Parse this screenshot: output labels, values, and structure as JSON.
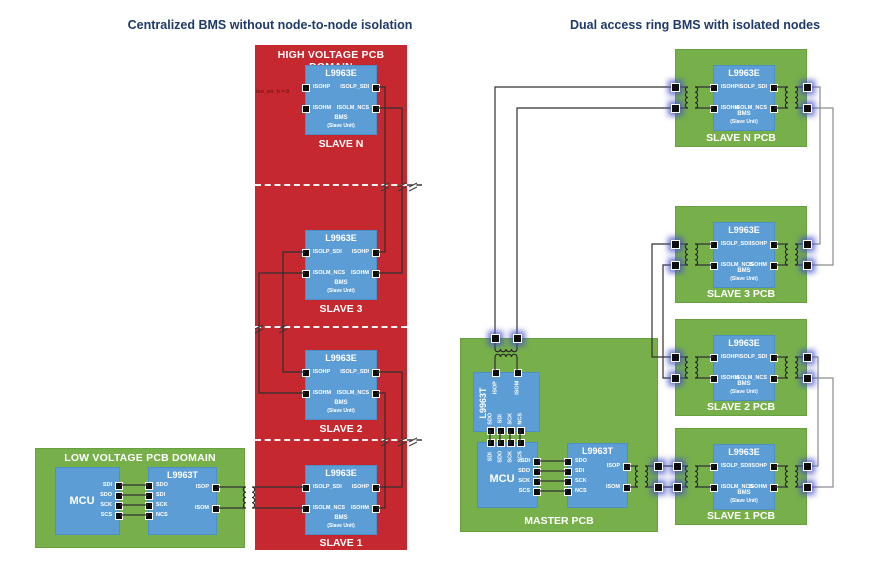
{
  "titles": {
    "left": "Centralized BMS without node-to-node isolation",
    "right": "Dual access ring BMS with isolated nodes"
  },
  "left_diagram": {
    "hv_domain": "HIGH VOLTAGE PCB DOMAIN",
    "lv_domain": "LOW VOLTAGE PCB DOMAIN",
    "iso_note": "iso_en_h = 0",
    "mcu": {
      "name": "MCU",
      "pins": [
        "SDI",
        "SDO",
        "SCK",
        "SCS"
      ]
    },
    "transceiver": {
      "name": "L9963T",
      "spi_pins": [
        "SDO",
        "SDI",
        "SCK",
        "NCS"
      ],
      "iso_pins": [
        "ISOP",
        "ISOM"
      ]
    },
    "slaves": [
      {
        "chip": "L9963E",
        "label": "SLAVE N",
        "core": "BMS",
        "core_sub": "(Slave Unit)",
        "left_pins": [
          "ISOHP",
          "ISOHM"
        ],
        "right_pins": [
          "ISOLP_SDI",
          "ISOLM_NCS"
        ]
      },
      {
        "chip": "L9963E",
        "label": "SLAVE 3",
        "core": "BMS",
        "core_sub": "(Slave Unit)",
        "left_pins": [
          "ISOLP_SDI",
          "ISOLM_NCS"
        ],
        "right_pins": [
          "ISOHP",
          "ISOHM"
        ]
      },
      {
        "chip": "L9963E",
        "label": "SLAVE 2",
        "core": "BMS",
        "core_sub": "(Slave Unit)",
        "left_pins": [
          "ISOHP",
          "ISOHM"
        ],
        "right_pins": [
          "ISOLP_SDI",
          "ISOLM_NCS"
        ]
      },
      {
        "chip": "L9963E",
        "label": "SLAVE 1",
        "core": "BMS",
        "core_sub": "(Slave Unit)",
        "left_pins": [
          "ISOLP_SDI",
          "ISOLM_NCS"
        ],
        "right_pins": [
          "ISOHP",
          "ISOHM"
        ]
      }
    ]
  },
  "right_diagram": {
    "master": {
      "label": "MASTER PCB",
      "mcu": {
        "name": "MCU",
        "top_pins": [
          "SDI",
          "SDO",
          "SCK",
          "SCS"
        ],
        "right_pins": [
          "SDI",
          "SDO",
          "SCK",
          "SCS"
        ]
      },
      "vertical_transceiver": {
        "name": "L9963T",
        "top_pins": [
          "ISOP",
          "ISOM"
        ],
        "bottom_pins": [
          "SDO",
          "SDI",
          "SCK",
          "NCS"
        ]
      },
      "horizontal_transceiver": {
        "name": "L9963T",
        "left_pins": [
          "SDO",
          "SDI",
          "SCK",
          "NCS"
        ],
        "right_pins": [
          "ISOP",
          "ISOM"
        ]
      }
    },
    "slaves": [
      {
        "pcb": "SLAVE N PCB",
        "chip": "L9963E",
        "core": "BMS",
        "core_sub": "(Slave Unit)",
        "left_pins": [
          "ISOHP",
          "ISOHM"
        ],
        "right_pins": [
          "ISOLP_SDI",
          "ISOLM_NCS"
        ]
      },
      {
        "pcb": "SLAVE 3 PCB",
        "chip": "L9963E",
        "core": "BMS",
        "core_sub": "(Slave Unit)",
        "left_pins": [
          "ISOLP_SDI",
          "ISOLM_NCS"
        ],
        "right_pins": [
          "ISOHP",
          "ISOHM"
        ]
      },
      {
        "pcb": "SLAVE 2 PCB",
        "chip": "L9963E",
        "core": "BMS",
        "core_sub": "(Slave Unit)",
        "left_pins": [
          "ISOHP",
          "ISOHM"
        ],
        "right_pins": [
          "ISOLP_SDI",
          "ISOLM_NCS"
        ]
      },
      {
        "pcb": "SLAVE 1 PCB",
        "chip": "L9963E",
        "core": "BMS",
        "core_sub": "(Slave Unit)",
        "left_pins": [
          "ISOLP_SDI",
          "ISOLM_NCS"
        ],
        "right_pins": [
          "ISOHP",
          "ISOHM"
        ]
      }
    ]
  },
  "colors": {
    "hv_red": "#c5282e",
    "pcb_green": "#77b04a",
    "chip_blue": "#5d9dd5",
    "title_navy": "#1f3a68",
    "wire_dark": "#303030",
    "wire_gray": "#8d8d8d",
    "connector_glow": "#4855c5"
  }
}
